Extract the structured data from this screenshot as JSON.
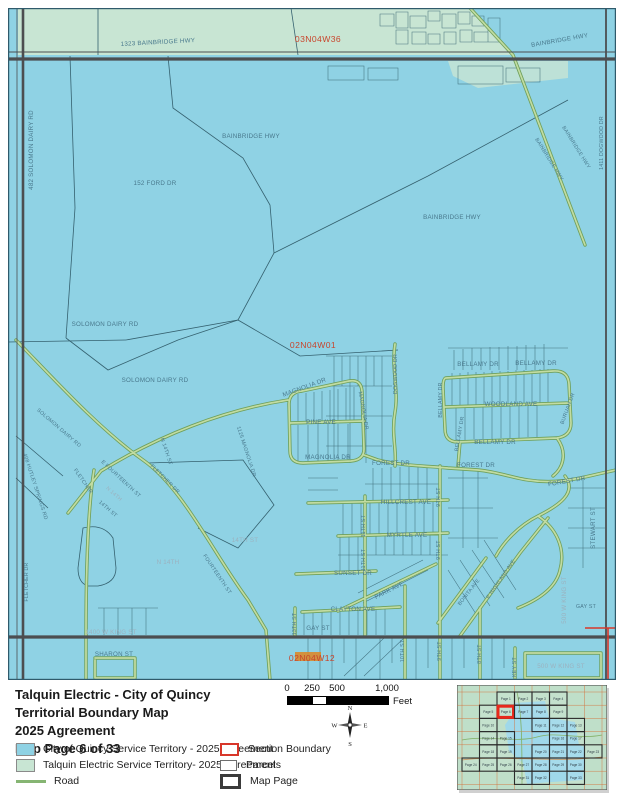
{
  "document": {
    "title_lines": [
      "Talquin Electric - City of Quincy",
      "Territorial Boundary Map",
      "2025 Agreement",
      "Map Page 6 of 33"
    ]
  },
  "legend": {
    "quincy_label": "City of Quincy Service Territory - 2025 Agreement",
    "talquin_label": "Talquin Electric Service Territory- 2025 Agreement",
    "road_label": "Road",
    "section_boundary_label": "Section Boundary",
    "parcels_label": "Parcels",
    "map_page_label": "Map Page"
  },
  "scale_bar": {
    "t0": "0",
    "t250": "250",
    "t500": "500",
    "t1000": "1,000",
    "unit": "Feet"
  },
  "compass": {
    "n": "N",
    "s": "S",
    "e": "E",
    "w": "W"
  },
  "colors": {
    "quincy_blue": "#8FD2E4",
    "talquin_green": "#C8E5D3",
    "road_green": "#86B573",
    "section_red": "#D8372A",
    "parcel_outline": "#6E6E6E",
    "map_page_outline": "#3B3B3B",
    "major_road_gray": "#4C4E50",
    "section_label_red": "#C8452C"
  },
  "map": {
    "labels": [
      "1323 BAINBRIDGE HWY",
      "03N04W36",
      "BAINBRIDGE HWY",
      "482 SOLOMON DAIRY RD",
      "BAINBRIDGE HWY",
      "152 FORD DR",
      "BAINBRIDGE HWY",
      "BAINBRIDGE HWY",
      "BAINBRIDGE HWY",
      "1411 DOGWOOD DR",
      "SOLOMON DAIRY RD",
      "02N04W01",
      "SOLOMON DAIRY RD",
      "SOLOMON DAIRY RD",
      "MAGNOLIA DR",
      "DOGWOOD DR",
      "BELLAMY DR",
      "BELLAMY DR",
      "MAGNOLIA DR",
      "BELLAMY DR",
      "WOODLAND AVE",
      "BURUAH DR",
      "PINE AVE",
      "BELLAMY DR",
      "BELLAMY DR",
      "MAGNOLIA DR",
      "FOREST DR",
      "FOREST DR",
      "FOREST DR",
      "1125 MAGNOLIA DR",
      "N 14TH ST",
      "HILLCREST AVE",
      "MYRTLE AVE",
      "11TH ST",
      "11TH ST",
      "9TH ST",
      "9TH ST",
      "SUNSET DR",
      "PARK AVE",
      "BONITA AVE",
      "E HIGHLAND AVE",
      "CLAYTON AVE",
      "STEWART ST",
      "500 W KING ST",
      "GAY ST",
      "GAY ST",
      "1400 W KING ST",
      "SHARON ST",
      "02N04W12",
      "500 W KING ST",
      "13TH ST",
      "10TH ST",
      "9TH ST",
      "8TH ST",
      "KEY ST",
      "E FOURTEENTH ST",
      "FLETCHER",
      "FLETCHER DR",
      "N 14TH",
      "14TH ST",
      "14TH ST",
      "N 14TH",
      "FOURTEENTH ST",
      "408 HUTLEY SPRINGS RD",
      "FLETCHER DR"
    ]
  },
  "inset": {
    "cells": [
      {
        "r": 0,
        "c": 2,
        "page": "Page 1"
      },
      {
        "r": 0,
        "c": 3,
        "page": "Page 2"
      },
      {
        "r": 0,
        "c": 4,
        "page": "Page 3"
      },
      {
        "r": 0,
        "c": 5,
        "page": "Page 4"
      },
      {
        "r": 1,
        "c": 1,
        "page": "Page 5"
      },
      {
        "r": 1,
        "c": 2,
        "page": "Page 6",
        "hl": true
      },
      {
        "r": 1,
        "c": 3,
        "page": "Page 7"
      },
      {
        "r": 1,
        "c": 4,
        "page": "Page 8"
      },
      {
        "r": 1,
        "c": 5,
        "page": "Page 9"
      },
      {
        "r": 2,
        "c": 1,
        "page": "Page 10"
      },
      {
        "r": 2,
        "c": 4,
        "page": "Page 11"
      },
      {
        "r": 2,
        "c": 5,
        "page": "Page 12"
      },
      {
        "r": 2,
        "c": 6,
        "page": "Page 13"
      },
      {
        "r": 3,
        "c": 1,
        "page": "Page 14"
      },
      {
        "r": 3,
        "c": 2,
        "page": "Page 15"
      },
      {
        "r": 3,
        "c": 5,
        "page": "Page 16"
      },
      {
        "r": 3,
        "c": 6,
        "page": "Page 17"
      },
      {
        "r": 4,
        "c": 1,
        "page": "Page 18"
      },
      {
        "r": 4,
        "c": 2,
        "page": "Page 19"
      },
      {
        "r": 4,
        "c": 4,
        "page": "Page 20"
      },
      {
        "r": 4,
        "c": 5,
        "page": "Page 21"
      },
      {
        "r": 4,
        "c": 6,
        "page": "Page 22"
      },
      {
        "r": 4,
        "c": 7,
        "page": "Page 23"
      },
      {
        "r": 5,
        "c": 0,
        "page": "Page 24"
      },
      {
        "r": 5,
        "c": 1,
        "page": "Page 25"
      },
      {
        "r": 5,
        "c": 2,
        "page": "Page 26"
      },
      {
        "r": 5,
        "c": 3,
        "page": "Page 27"
      },
      {
        "r": 5,
        "c": 4,
        "page": "Page 28"
      },
      {
        "r": 5,
        "c": 5,
        "page": "Page 29"
      },
      {
        "r": 5,
        "c": 6,
        "page": "Page 30"
      },
      {
        "r": 6,
        "c": 3,
        "page": "Page 31"
      },
      {
        "r": 6,
        "c": 4,
        "page": "Page 32"
      },
      {
        "r": 6,
        "c": 6,
        "page": "Page 33"
      }
    ]
  }
}
